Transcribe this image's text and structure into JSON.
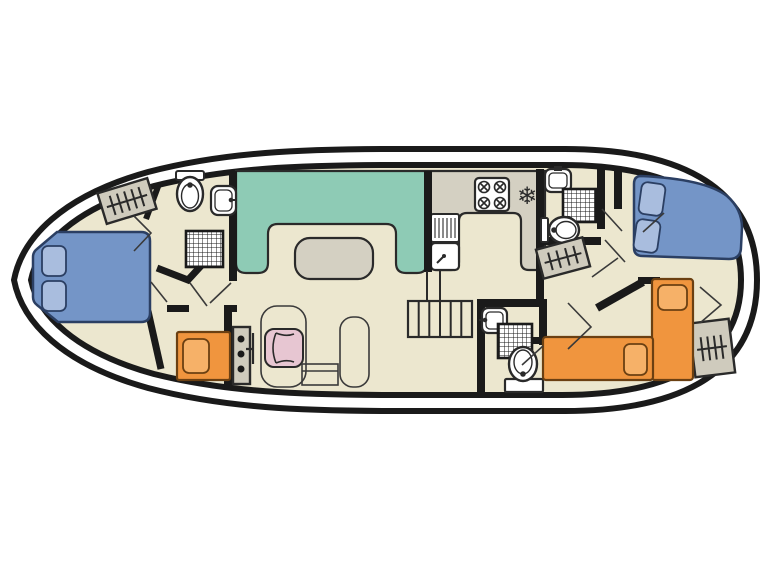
{
  "diagram": {
    "type": "boat-floor-plan",
    "freezer_symbol": "❄"
  },
  "palette": {
    "background": "#ffffff",
    "hull_stroke": "#1a1a1a",
    "floor": "#ece7cf",
    "wall": "#1a1a1a",
    "bench_green": "#8ecbb5",
    "table_gray": "#d4d0c2",
    "counter_gray": "#d4d0c2",
    "bed_blue": "#7495c7",
    "pillow_blue": "#a9bdde",
    "bed_blue_outline": "#2b3f63",
    "bed_orange": "#f0953e",
    "pillow_orange": "#f6b168",
    "bed_orange_outline": "#6b4012",
    "seat_pink": "#e7c6d2",
    "hatch_gray": "#cfcbbd",
    "fixture_white": "#ffffff",
    "outline_dark": "#2a2a2a",
    "thin_line": "#3a3a3a"
  },
  "rooms": [
    {
      "name": "bow-cabin",
      "furniture": [
        "double-bed",
        "bench-seat"
      ]
    },
    {
      "name": "bow-bathroom",
      "fixtures": [
        "toilet",
        "washbasin",
        "shower"
      ]
    },
    {
      "name": "dinette",
      "furniture": [
        "u-shaped-bench",
        "table"
      ]
    },
    {
      "name": "helm-station",
      "furniture": [
        "instrument-console",
        "steering-wheel",
        "helm-seat"
      ]
    },
    {
      "name": "galley",
      "fixtures": [
        "sink-with-drainer",
        "four-burner-hob",
        "refrigerator"
      ]
    },
    {
      "name": "midship-bathroom",
      "fixtures": [
        "washbasin",
        "shower",
        "toilet"
      ]
    },
    {
      "name": "aft-bathroom",
      "fixtures": [
        "washbasin",
        "shower",
        "toilet"
      ]
    },
    {
      "name": "stern-cabin",
      "furniture": [
        "double-bed"
      ]
    },
    {
      "name": "aft-twin-cabin",
      "furniture": [
        "single-bed",
        "single-bed"
      ]
    },
    {
      "name": "companionway-steps",
      "count": 4
    }
  ]
}
